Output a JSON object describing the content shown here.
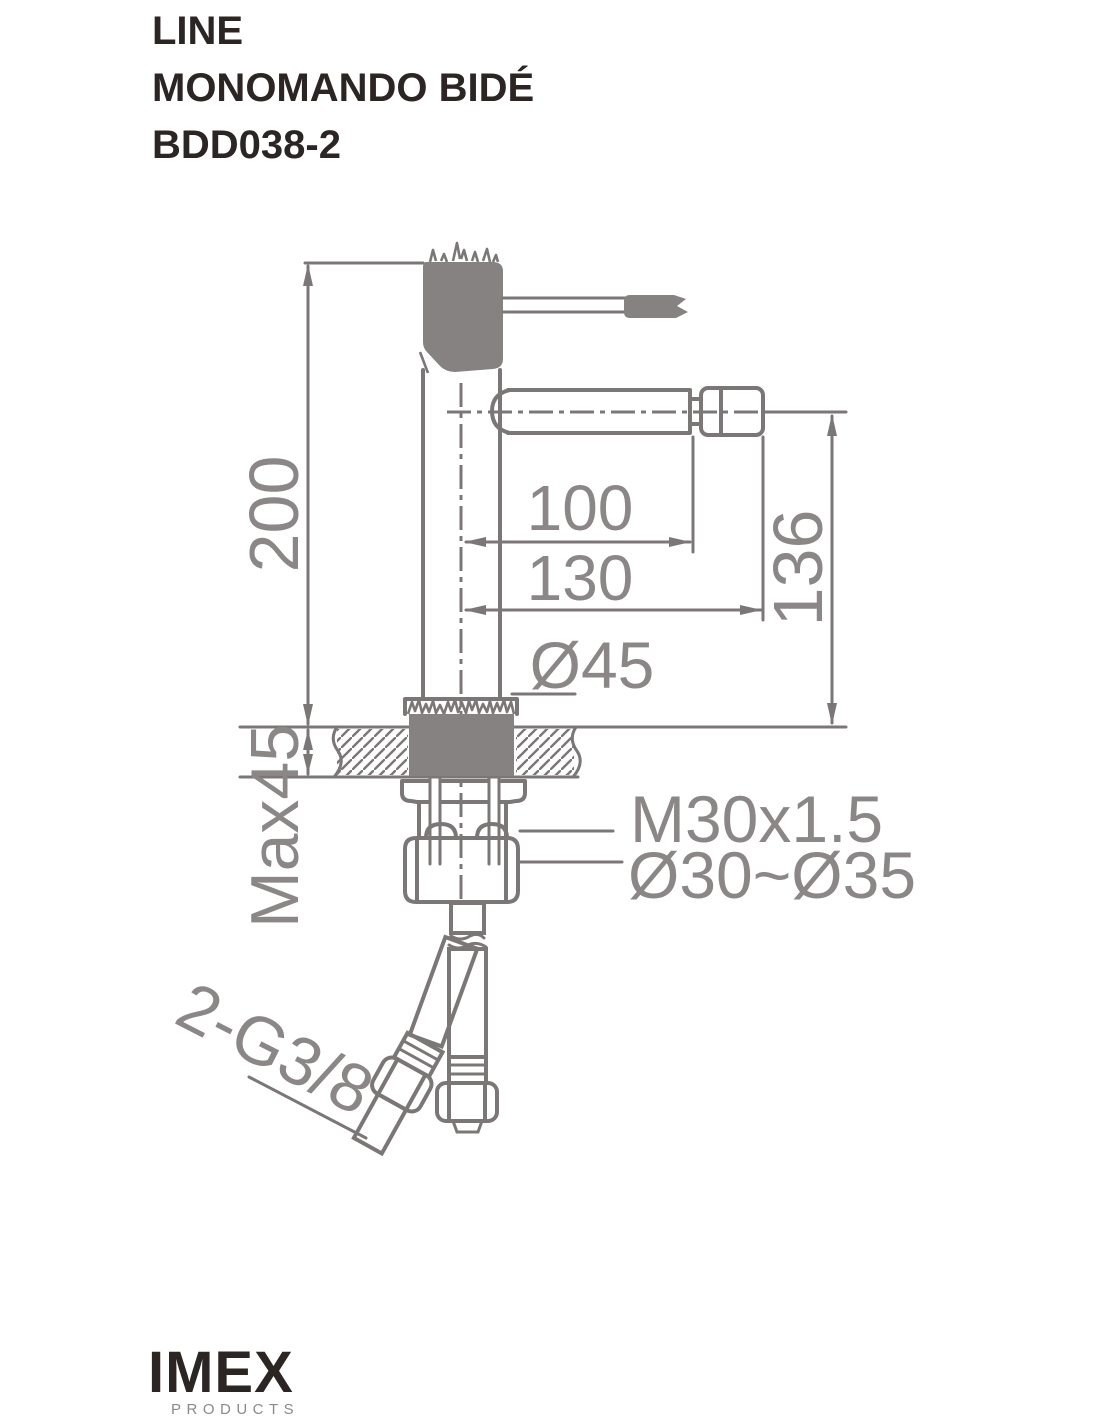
{
  "header": {
    "line1": "LINE",
    "line2": "MONOMANDO BIDÉ",
    "line3": "BDD038-2"
  },
  "drawing": {
    "type": "technical-dimension-drawing",
    "subject": "single-lever bidet mixer tap, side view with counter cross-section and supply hoses",
    "dimensions": {
      "total_height": "200",
      "counter_thickness_max": "Max45",
      "spout_reach": "100",
      "total_reach": "130",
      "base_diameter": "Ø45",
      "spout_height_above_counter": "136",
      "shank_thread": "M30x1.5",
      "mounting_hole_range": "Ø30~Ø35",
      "inlet_hoses": "2-G3/8"
    }
  },
  "footer": {
    "brand": "IMEX",
    "tagline": "PRODUCTS"
  },
  "colors": {
    "line": "#7b7777",
    "dark_fill": "#868282",
    "dimension_text": "#8b8787",
    "title_text": "#2b2523",
    "logo_sub_text": "#8a8a8a",
    "background": "#ffffff"
  }
}
